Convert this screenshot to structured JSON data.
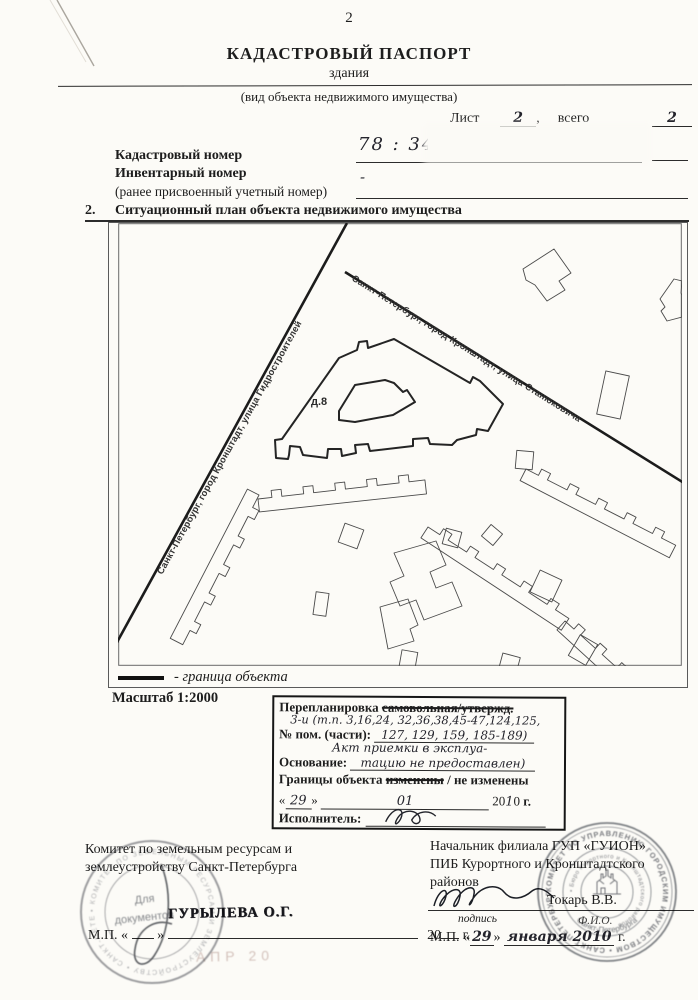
{
  "page_number": "2",
  "header": {
    "title": "КАДАСТРОВЫЙ ПАСПОРТ",
    "subtitle": "здания",
    "subtitle_note": "(вид объекта недвижимого имущества)",
    "sheet_label": "Лист №",
    "sheet_number": "2",
    "comma": ",",
    "total_label": "всего листов",
    "total_number": "2"
  },
  "numbers": {
    "cadastral_label": "Кадастровый номер",
    "cadastral_value": "78 : 34 : 10",
    "inventory_label": "Инвентарный номер",
    "inventory_value": "-",
    "inventory_note": "(ранее присвоенный учетный номер)"
  },
  "section": {
    "number": "2.",
    "title": "Ситуационный план объекта недвижимого имущества"
  },
  "map": {
    "street_hydro": "Санкт-Петербург, город Кронштадт, улица Гидростроителей",
    "street_stan": "Санкт-Петербург, город Кронштадт, улица Станюковича",
    "building_label": "д.8",
    "legend_text": "- граница объекта",
    "scale_label": "Масштаб  1:2000"
  },
  "remark": {
    "line1_prefix": "Перепланировка",
    "line1_struck": "самовольная/утвержд.",
    "hand_numbers": "3-и (т.п. 3,16,24, 32,36,38,45-47,124,125,",
    "rooms_label": "№ пом. (части):",
    "rooms_value": "127, 129, 159, 185-189)",
    "hand_act": "Акт приемки в эксплуа-",
    "basis_label": "Основание:",
    "basis_value": "тацию не предоставлен)",
    "borders_prefix": "Границы объекта",
    "borders_struck": "изменены",
    "borders_rest": "/ не изменены",
    "q_open": "«",
    "date_day": "29",
    "q_close": "»",
    "date_month": "01",
    "year_prefix": "20",
    "year_hand": "1",
    "year_tail": "0",
    "year_suffix": "г.",
    "executor_label": "Исполнитель:"
  },
  "left_block": {
    "org_line1": "Комитет по земельным ресурсам и",
    "org_line2": "землеустройству Санкт-Петербурга",
    "name_stamp": "ГУРЫЛЕВА О.Г.",
    "mp_prefix": "М.П. «",
    "q_close": "»",
    "year_blank": "20",
    "year_suffix": "г.",
    "faint_stamp": "АПР 20",
    "stamp_center1": "Для",
    "stamp_center2": "документов",
    "stamp_ring": "• КОМИТЕТ ПО ЗЕМЕЛЬНЫМ РЕСУРСАМ И ЗЕМЛЕУСТРОЙСТВУ • САНКТ-ПЕТЕРБУРГ "
  },
  "right_block": {
    "title_line1": "Начальник филиала ГУП «ГУИОН»",
    "title_line2": "ПИБ Курортного и Кронштадтского",
    "title_line3": "районов",
    "signature_name": "Токарь В.В.",
    "sign_caption": "подпись",
    "fio_caption": "Ф.И.О.",
    "mp_prefix": "М.П. «",
    "date_day": "29",
    "q_close": "»",
    "date_rest": "января 2010",
    "date_suffix": "г.",
    "stamp_ring_outer": "КОМИТЕТ ПО УПРАВЛЕНИЮ ГОРОДСКИМ ИМУЩЕСТВОМ • САНКТ-ПЕТЕРБУРГ • ",
    "stamp_ring_inner": "• Бюро Курортного и Кронштадтского районов",
    "stamp_bottom": "Санкт-Петербурга"
  }
}
